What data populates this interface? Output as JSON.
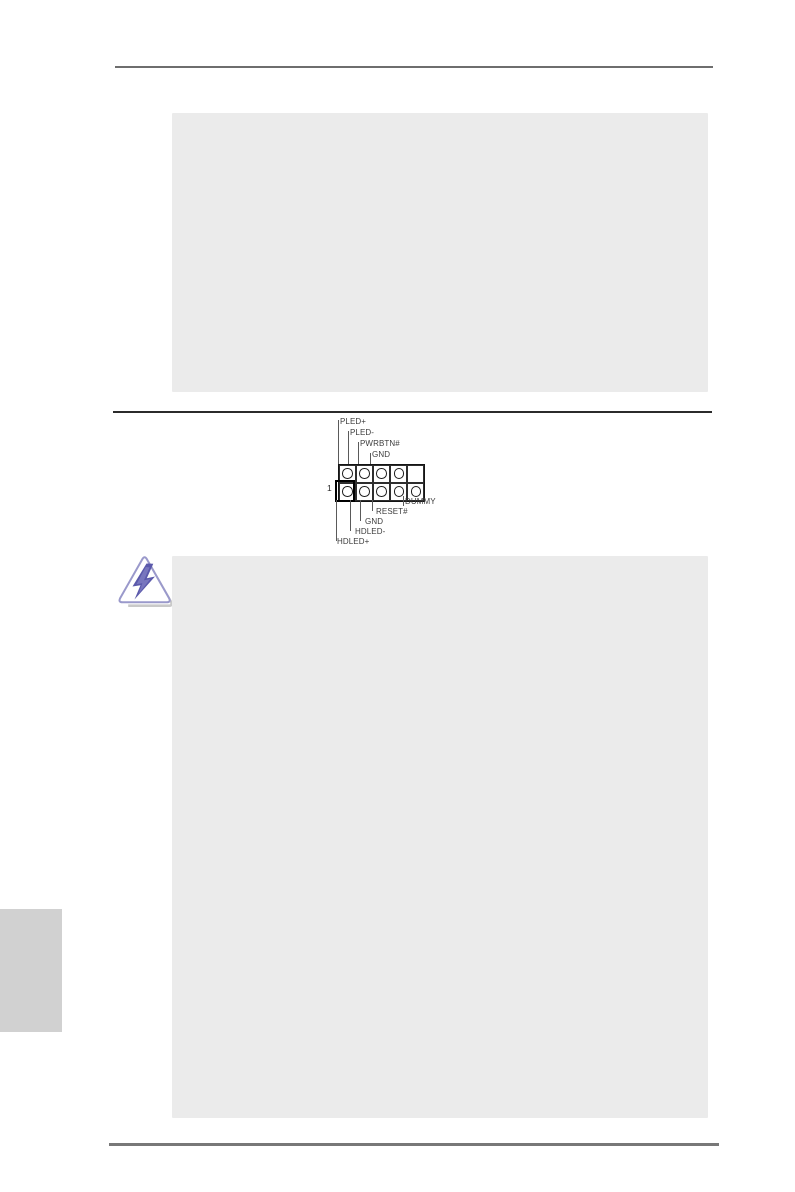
{
  "document": {
    "kind": "motherboard-manual-page",
    "note_boxes": [
      {
        "id": "top-note",
        "content": ""
      },
      {
        "id": "caution-note",
        "content": ""
      }
    ]
  },
  "panel_header_diagram": {
    "top_pin_labels": [
      "PLED+",
      "PLED-",
      "PWRBTN#",
      "GND"
    ],
    "bottom_pin_labels": [
      "DUMMY",
      "RESET#",
      "GND",
      "HDLED-",
      "HDLED+"
    ],
    "pin_one_label": "1",
    "grid": {
      "rows": 2,
      "cols": 5,
      "missing": [
        [
          0,
          4
        ]
      ],
      "pin_one": [
        1,
        0
      ]
    }
  },
  "icons": {
    "caution": {
      "name": "caution-lightning-icon",
      "outline_color": "#9a99cb",
      "bolt_color": "#5b59ab",
      "bolt_highlight": "#8f8ecd",
      "shadow_color": "#c9c9c9"
    }
  },
  "colors": {
    "page_bg": "#ffffff",
    "note_box_bg": "#ebebeb",
    "side_tab_bg": "#d1d1d1",
    "rule_top": "#6e6e6e",
    "rule_mid": "#2b2b2b",
    "rule_bottom": "#787878"
  }
}
